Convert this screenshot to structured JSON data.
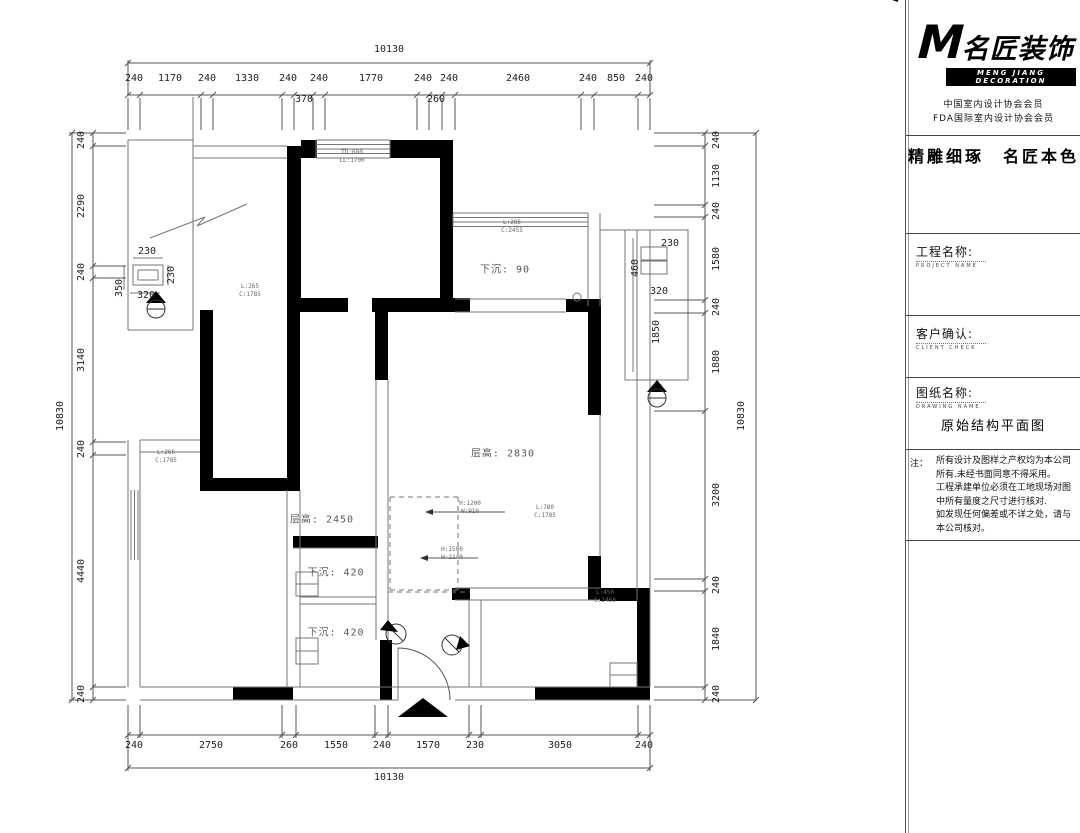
{
  "dims": {
    "top": {
      "total": "10130",
      "segments": [
        "240",
        "1170",
        "240",
        "1330",
        "240",
        "370",
        "240",
        "1770",
        "240",
        "260",
        "240",
        "2460",
        "240",
        "850",
        "240"
      ]
    },
    "bottom": {
      "total": "10130",
      "segments": [
        "240",
        "2750",
        "260",
        "1550",
        "240",
        "1570",
        "230",
        "3050",
        "240"
      ]
    },
    "left": {
      "total": "10830",
      "segments": [
        "240",
        "2290",
        "240",
        "3140",
        "240",
        "4440",
        "240"
      ]
    },
    "right": {
      "total": "10830",
      "segments": [
        "240",
        "1130",
        "240",
        "1580",
        "240",
        "1880",
        "3200",
        "240",
        "1840",
        "240"
      ]
    },
    "left_detail": {
      "top": "230",
      "right": "230",
      "left": "350",
      "bottom": "320"
    },
    "right_detail": {
      "top": "230",
      "left": "460",
      "mid": "320",
      "bottom": "1850"
    }
  },
  "rooms": {
    "sunken_90": "下沉: 90",
    "height_2830": "层高: 2830",
    "height_2450": "层高: 2450",
    "sunken_420_a": "下沉: 420",
    "sunken_420_b": "下沉: 420",
    "bay_line1": "TD:680",
    "bay_line2": "LL:1700"
  },
  "beams": [
    {
      "l": "L:285",
      "c": "C:2455"
    },
    {
      "l": "L:265",
      "c": "C:1785"
    },
    {
      "l": "L:265",
      "c": "C:1785"
    },
    {
      "l": "L:780",
      "c": "C:1785"
    },
    {
      "l": "L:450",
      "c": "C:1460"
    }
  ],
  "leaders": [
    {
      "line1": "H:1200",
      "line2": "W:910"
    },
    {
      "line1": "H:1500",
      "line2": "W:2140"
    }
  ],
  "titleblock": {
    "logo_cn": "名匠装饰",
    "logo_en": "MENG JIANG DECORATION",
    "member1": "中国室内设计协会会员",
    "member2": "FDA国际室内设计协会会员",
    "slogan": "精雕细琢　名匠本色",
    "fields": [
      {
        "label": "工程名称:",
        "sub": "PROJECT NAME"
      },
      {
        "label": "客户确认:",
        "sub": "CLIENT CHECK"
      },
      {
        "label": "图纸名称:",
        "sub": "DRAWING NAME"
      }
    ],
    "drawing_name": "原始结构平面图",
    "note_label": "注：",
    "notes": [
      "所有设计及图样之产权均为本公司",
      "所有.未经书面同意不得采用。",
      "工程承建单位必须在工地现场对图",
      "中所有量度之尺寸进行核对.",
      "如发现任何偏差或不详之处，请与",
      "本公司核对。"
    ]
  }
}
